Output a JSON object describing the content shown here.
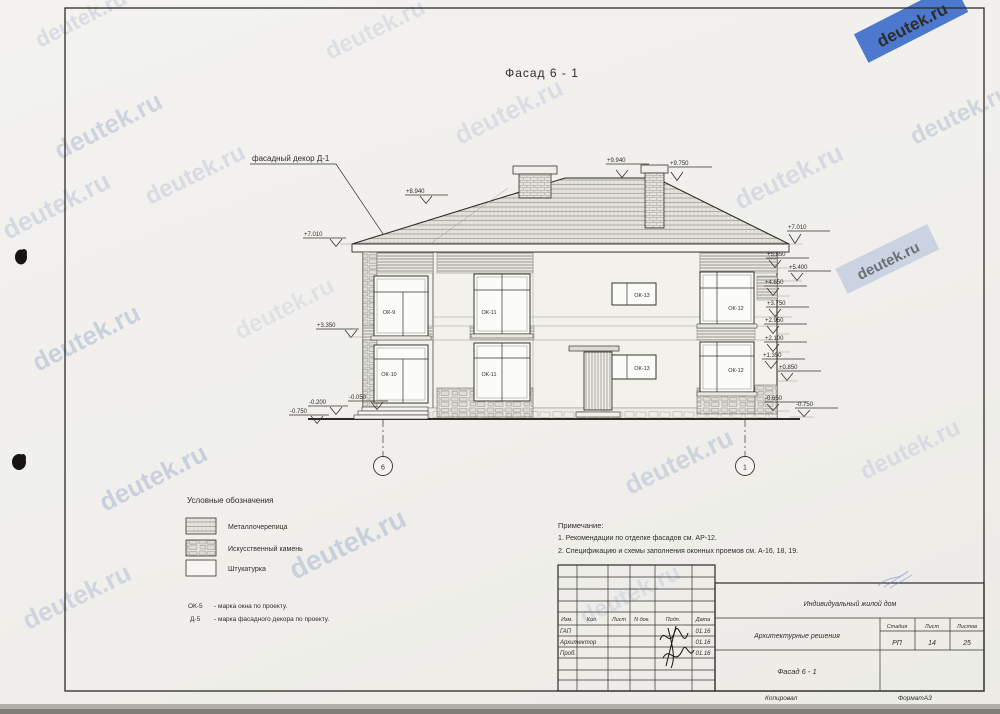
{
  "watermark": {
    "text": "deutek.ru"
  },
  "page": {
    "title": "Фасад 6 - 1"
  },
  "drawing": {
    "decor_label": "фасадный декор Д-1",
    "axes": [
      "6",
      "1"
    ],
    "elev_top": [
      "+9.940",
      "+9.750"
    ],
    "elev_left": [
      "+8.940",
      "+7.010",
      "+3.350",
      "-0.050",
      "-0.200",
      "-0.750"
    ],
    "elev_right": [
      "+7.010",
      "+5.850",
      "+5.400",
      "+4.650",
      "+3.750",
      "+2.950",
      "+2.100",
      "+1.350",
      "+0.850",
      "-0.650",
      "-0.750"
    ],
    "windows": {
      "w1": "ОК-9",
      "w2": "ОК-11",
      "w3": "ОК-13",
      "w4": "ОК-12",
      "w5": "ОК-10",
      "w6": "ОК-11",
      "w7": "ОК-13",
      "w8": "ОК-12"
    }
  },
  "legend": {
    "title": "Условные обозначения",
    "items": [
      {
        "label": "Металлочерепица"
      },
      {
        "label": "Искусственный камень"
      },
      {
        "label": "Штукатурка"
      }
    ],
    "marks": [
      {
        "code": "ОК-5",
        "desc": "- марка окна по проекту."
      },
      {
        "code": "Д-5",
        "desc": "- марка фасадного декора по проекту."
      }
    ]
  },
  "notes": {
    "title": "Примечание:",
    "line1": "1. Рекомендации по отделке фасадов см. АР-12.",
    "line2": "2. Спецификацию и схемы заполнения оконных проемов см. А-16, 18, 19."
  },
  "stamp": {
    "cols": [
      "Изм.",
      "Кол.",
      "Лист",
      "N док.",
      "Подп.",
      "Дата"
    ],
    "rows": [
      {
        "role": "ГАП",
        "date": "01.16"
      },
      {
        "role": "Архитектор",
        "date": "01.16"
      },
      {
        "role": "Проб.",
        "date": "01.16"
      }
    ],
    "project": "Индивидуальный жилой дом",
    "set_name": "Архитектурные решения",
    "stage_label": "Стадия",
    "sheet_label": "Лист",
    "sheets_label": "Листов",
    "stage": "РП",
    "sheet": "14",
    "sheets": "25",
    "drawing_name": "Фасад 6 - 1",
    "copied": "Копировал",
    "format": "ФорматА3"
  }
}
